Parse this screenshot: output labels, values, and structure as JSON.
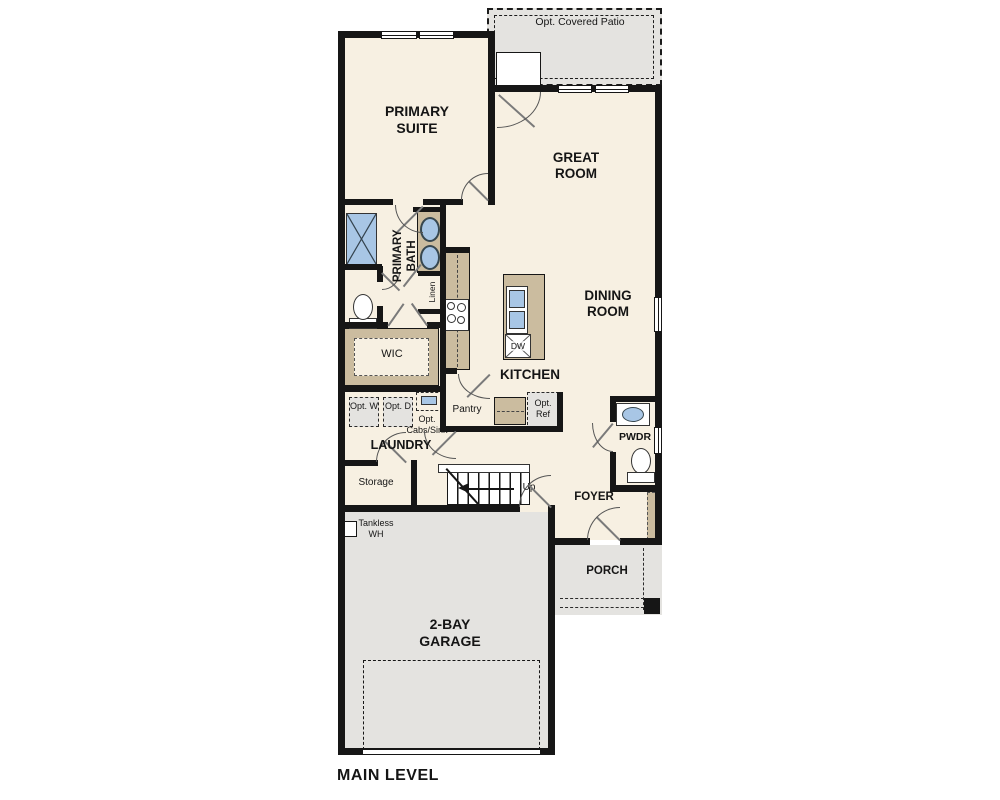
{
  "title": "MAIN LEVEL",
  "labels": {
    "opt_covered_patio": "Opt. Covered Patio",
    "primary_suite": "PRIMARY SUITE",
    "great_room": "GREAT ROOM",
    "dining_room": "DINING ROOM",
    "primary_bath": "PRIMARY BATH",
    "linen": "Linen",
    "wic": "WIC",
    "kitchen": "KITCHEN",
    "dw": "DW",
    "pantry": "Pantry",
    "opt_ref": "Opt. Ref",
    "opt_w": "Opt. W",
    "opt_d": "Opt. D",
    "opt_cabs_sink": "Opt. Cabs/Sink",
    "laundry": "LAUNDRY",
    "storage": "Storage",
    "up": "Up",
    "foyer": "FOYER",
    "pwdr": "PWDR",
    "porch": "PORCH",
    "tankless_wh": "Tankless WH",
    "garage": "2-BAY GARAGE",
    "main_level": "MAIN LEVEL"
  },
  "colors": {
    "floor_cream": "#f7f0e2",
    "cabinet_tan": "#cbbc9f",
    "area_gray": "#e4e3e0",
    "fixture_blue": "#a8c6e5",
    "wall_black": "#161616"
  }
}
